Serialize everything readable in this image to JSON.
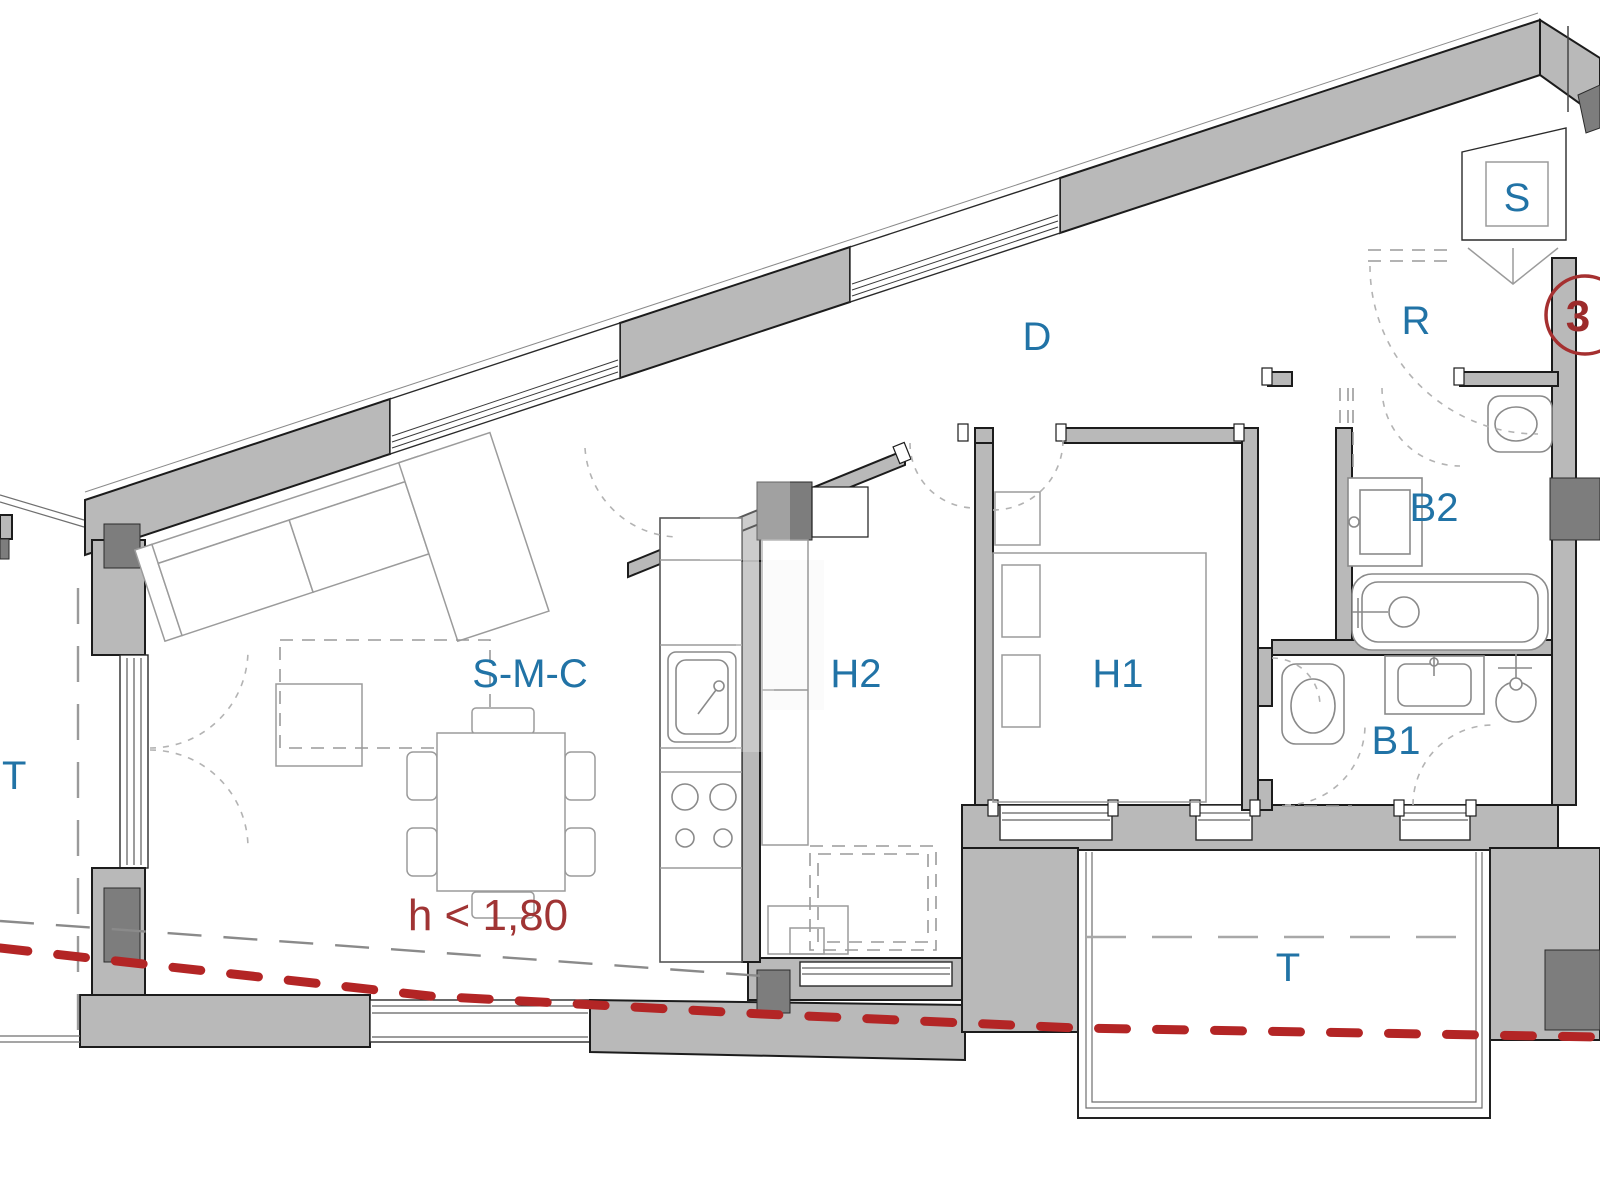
{
  "plan": {
    "type": "apartment-floor-plan",
    "unit_number": "3",
    "annotation": {
      "height_limit": "h < 1,80"
    },
    "rooms": [
      {
        "id": "smc",
        "label": "S-M-C"
      },
      {
        "id": "h1",
        "label": "H1"
      },
      {
        "id": "h2",
        "label": "H2"
      },
      {
        "id": "b1",
        "label": "B1"
      },
      {
        "id": "b2",
        "label": "B2"
      },
      {
        "id": "d",
        "label": "D"
      },
      {
        "id": "r",
        "label": "R"
      },
      {
        "id": "s",
        "label": "S"
      },
      {
        "id": "t_left",
        "label": "T"
      },
      {
        "id": "t_bottom",
        "label": "T"
      }
    ],
    "colors": {
      "label_blue": "#2173a6",
      "annotation_red": "#a03434",
      "section_line_red": "#b32525",
      "wall_gray": "#b9b9b9",
      "pillar_gray": "#7d7d7d"
    }
  }
}
